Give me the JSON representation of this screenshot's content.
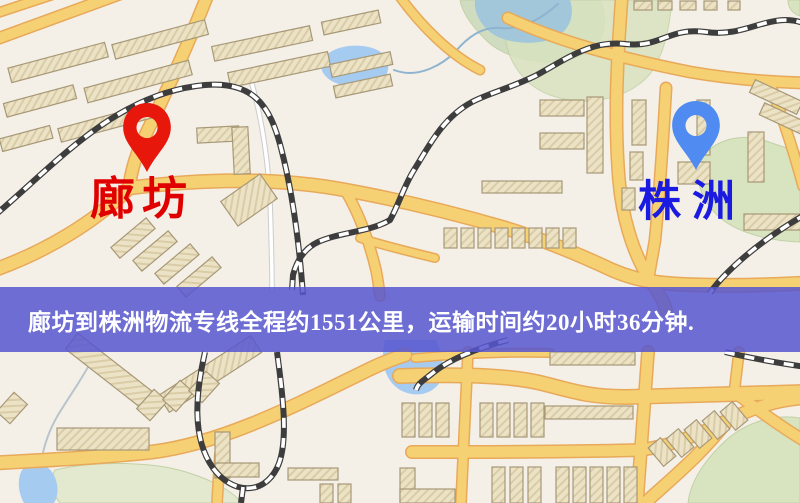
{
  "map": {
    "origin": {
      "label": "廊坊"
    },
    "destination": {
      "label": "株洲"
    },
    "banner": {
      "text": "廊坊到株洲物流专线全程约1551公里，运输时间约20小时36分钟."
    },
    "route": {
      "from": "廊坊",
      "to": "株洲",
      "distance_text": "约1551公里",
      "duration_text": "约20小时36分钟"
    }
  },
  "theme": {
    "origin_pin": "#e8170b",
    "origin_text": "#e00000",
    "dest_pin": "#4f8bf0",
    "dest_text": "#1a1ae0",
    "banner_bg": "rgba(86,86,208,0.85)",
    "banner_text": "#ffffff",
    "road_fill": "#f6d173",
    "road_casing": "#e8a95a",
    "water": "#a6cbf0",
    "park": "#d8e3c0",
    "building": "#ece3c6",
    "railway": "#3d3d3d"
  }
}
